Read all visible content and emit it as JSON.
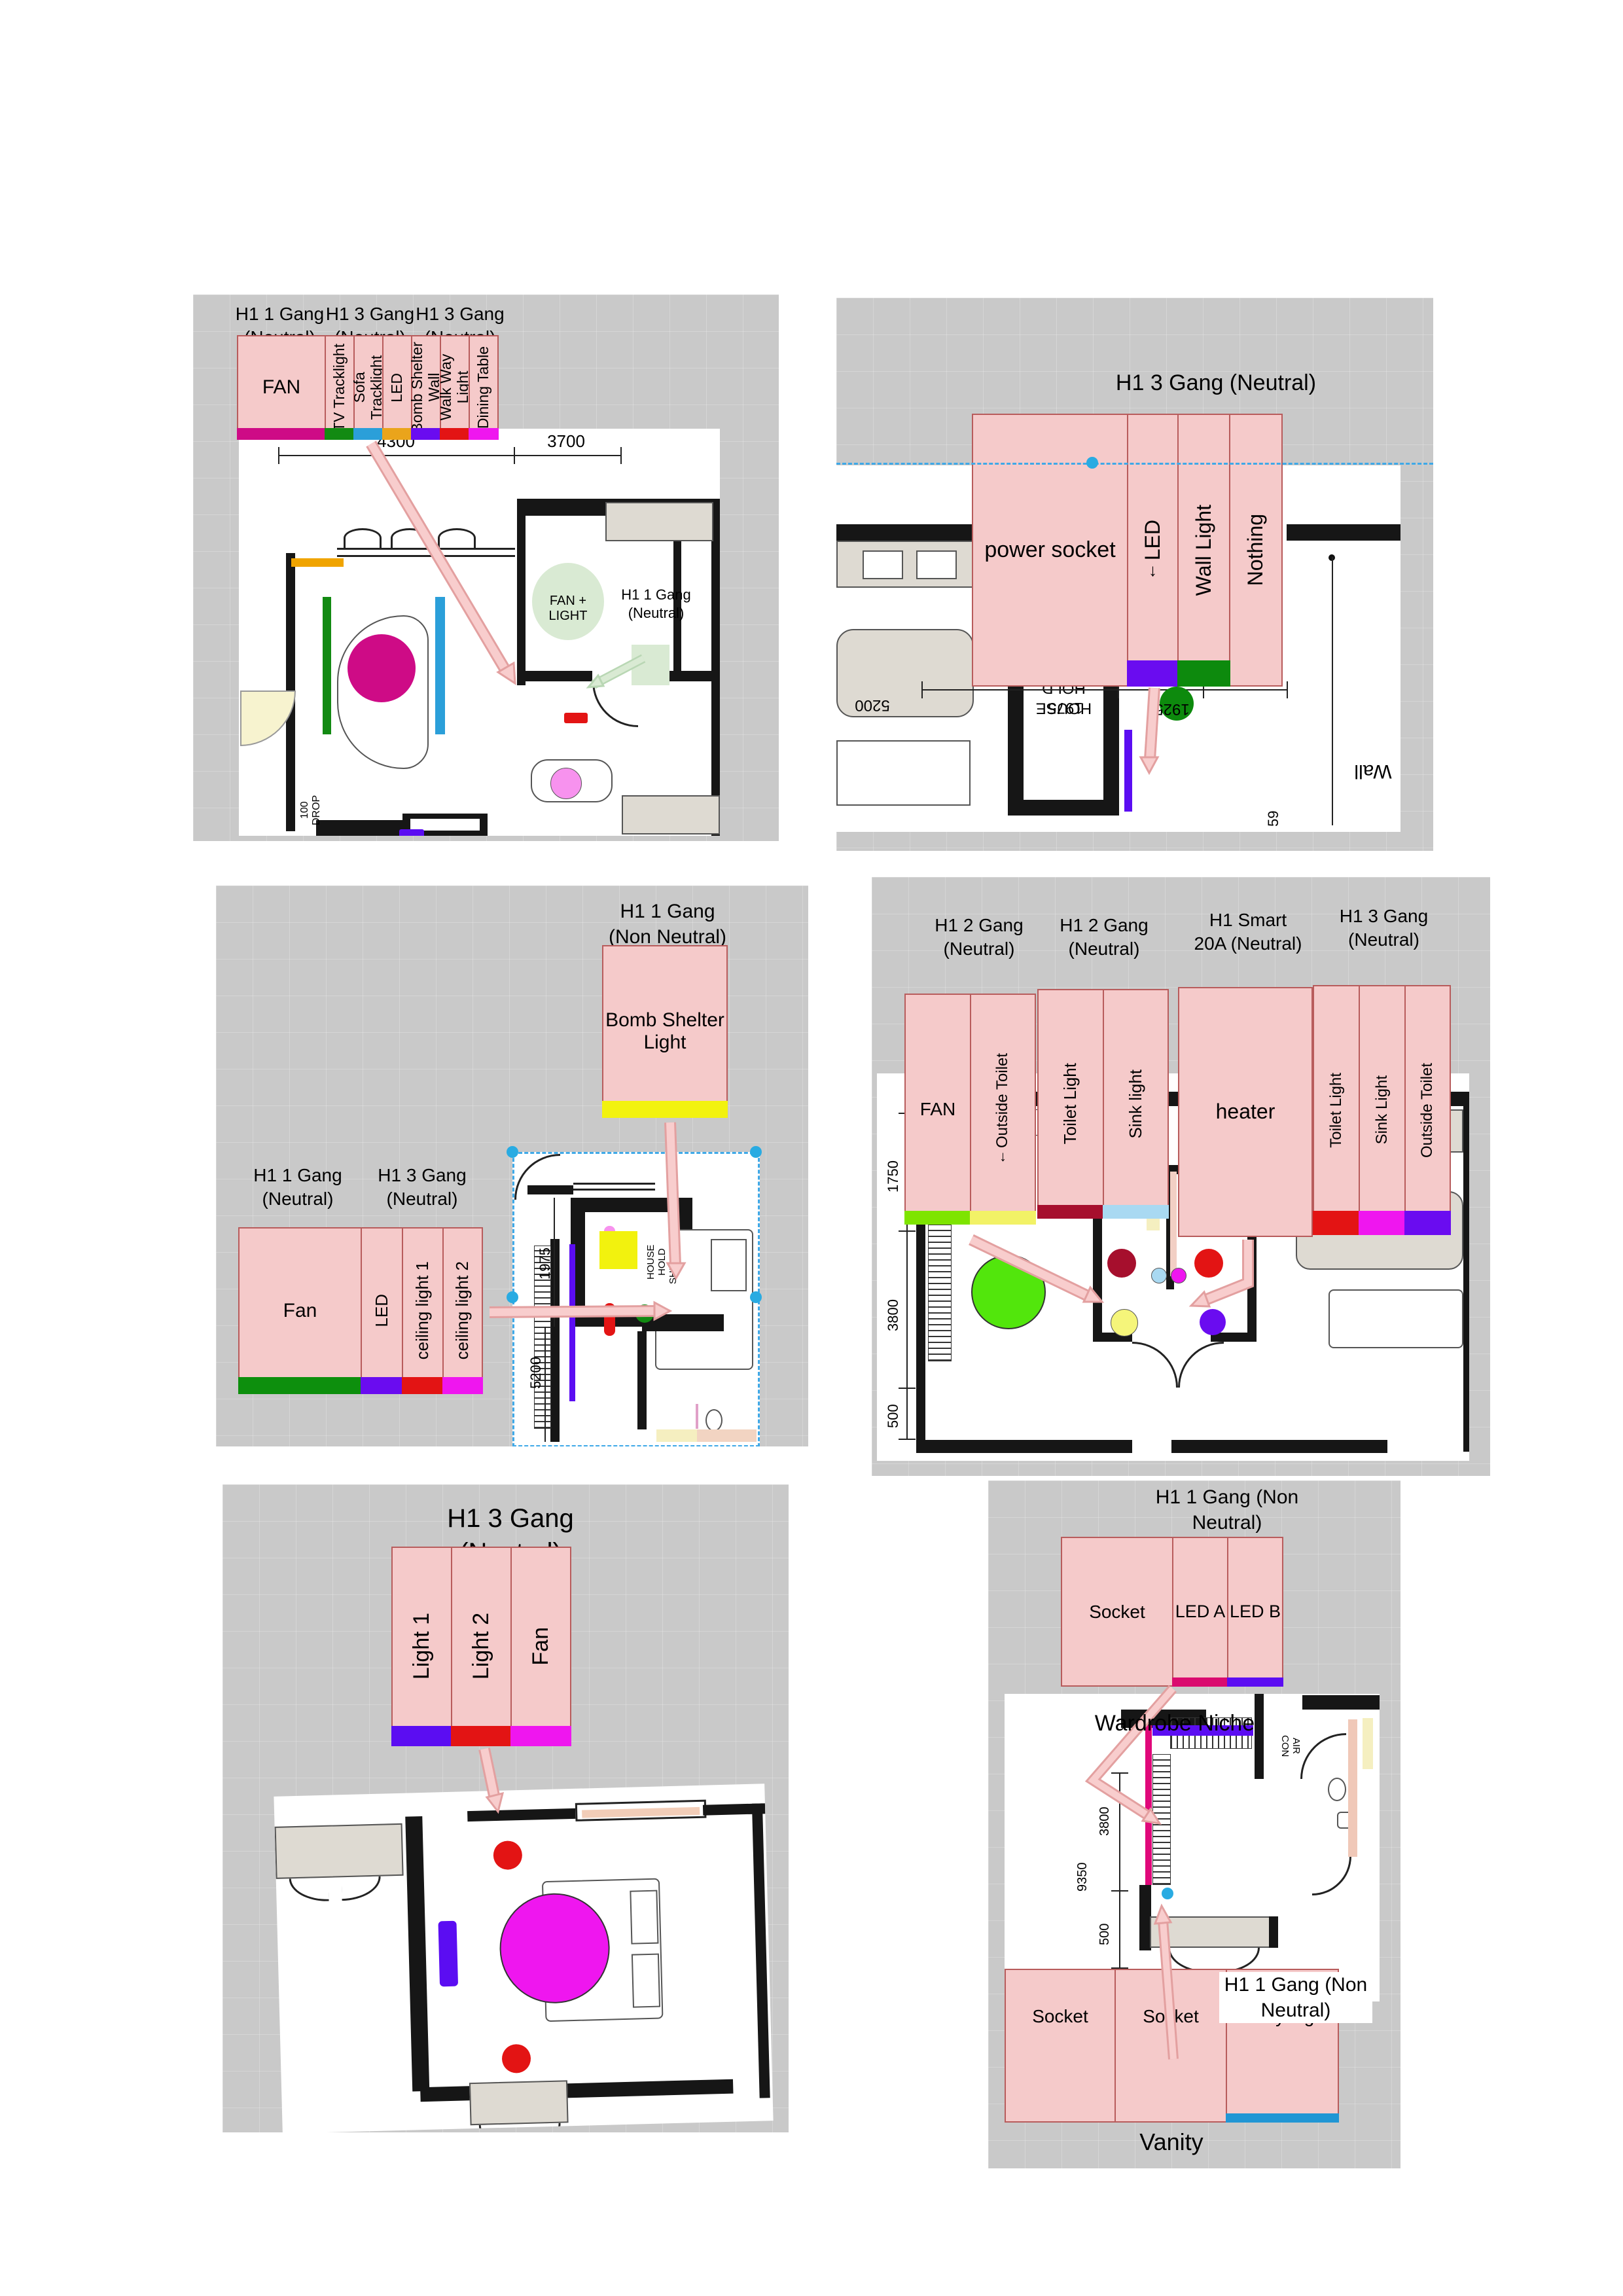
{
  "page": {
    "background": "#ffffff",
    "panel_background": "#c9c9c9"
  },
  "icons": {
    "down_arrow": "↓"
  },
  "colors": {
    "arrow_pink": "#f8cdcd",
    "arrow_pink_edge": "#e3a0a0",
    "dashed_blue": "#3fa9e8",
    "handle_blue": "#29abe2",
    "switch_fill": "#f5caca",
    "switch_border": "#b85c5c"
  },
  "panels": {
    "living": {
      "groups": [
        {
          "title": "H1 1 Gang\n(Neutral)"
        },
        {
          "title": "H1 3 Gang\n(Neutral)"
        },
        {
          "title": "H1 3 Gang\n(Neutral)"
        }
      ],
      "gangs": [
        {
          "label": "FAN",
          "color": "#ce0b86"
        },
        {
          "label": "TV Tracklight",
          "color": "#128a12"
        },
        {
          "label": "Sofa Tracklight",
          "color": "#2b9fd9"
        },
        {
          "label": "LED",
          "color": "#eaa41b"
        },
        {
          "label": "Bomb Shelter Wall",
          "color": "#6a0cf0"
        },
        {
          "label": "Walk Way Light",
          "color": "#e31414"
        },
        {
          "label": "Dining Table",
          "color": "#ef16ef"
        }
      ],
      "dims": {
        "a": "4300",
        "b": "3700"
      },
      "plan": {
        "fan_light": "FAN + LIGHT",
        "gang_note": "H1 1 Gang\n(Neutral)",
        "drop": "100\nDROP"
      },
      "markers": {
        "orange_bar": "#f0a400",
        "green_bar": "#128a12",
        "magenta_circle": "#ce0b86",
        "blue_bar": "#2b9fd9",
        "red_rect": "#e31414",
        "pink_circle": "#f792ee",
        "purple_rect": "#5b0df2",
        "fan_light_fill": "#d9ead3"
      }
    },
    "entry": {
      "title": "H1 3 Gang (Neutral)",
      "gangs": [
        {
          "label": "power socket",
          "color": null
        },
        {
          "label": "LED",
          "color": "#6a0cf0"
        },
        {
          "label": "Wall Light",
          "color": "#0d8a0d"
        },
        {
          "label": "Nothing",
          "color": null
        }
      ],
      "dims": {
        "a": "5200",
        "b": "1975",
        "c": "1925",
        "d": "59"
      },
      "plan": {
        "shelter": "HOUSE\nHOLD\nSHELTER",
        "drop": "100\nDROP",
        "wall": "Wall"
      },
      "markers": {
        "purple_bar": "#5b0df2",
        "green_circle": "#0d8a0d"
      }
    },
    "bedroom2": {
      "bomb_title": "H1 1 Gang\n(Non Neutral)",
      "bomb_label": "Bomb Shelter\nLight",
      "bomb_color": "#f2f20e",
      "groups": [
        {
          "title": "H1 1 Gang\n(Neutral)"
        },
        {
          "title": "H1 3 Gang\n(Neutral)"
        }
      ],
      "gangs": [
        {
          "label": "Fan",
          "color": "#0d8f0d"
        },
        {
          "label": "LED",
          "color": "#6a0cf0"
        },
        {
          "label": "ceiling light 1",
          "color": "#e31414"
        },
        {
          "label": "ceiling light 2",
          "color": "#ef16ef"
        }
      ],
      "dims": {
        "a": "1975",
        "b": "5200"
      },
      "plan": {
        "shelter": "HOUSE\nHOLD\nSHELTER"
      },
      "markers": {
        "yellow_square": "#f2f20e",
        "purple_bar": "#5b0df2",
        "pink_bar": "#f792ee",
        "red_bar": "#e31414",
        "green_circle": "#128a12"
      }
    },
    "bedroom3": {
      "groups": [
        {
          "title": "H1 2 Gang\n(Neutral)"
        },
        {
          "title": "H1 2 Gang\n(Neutral)"
        },
        {
          "title": "H1 Smart\n20A (Neutral)"
        },
        {
          "title": "H1 3 Gang\n(Neutral)"
        }
      ],
      "gangs_a": [
        {
          "label": "FAN",
          "color": "#7ee400"
        },
        {
          "label": "Outside Toilet",
          "color": "#f2f266"
        }
      ],
      "gangs_b": [
        {
          "label": "Toilet Light",
          "color": "#a60f2d"
        },
        {
          "label": "Sink light",
          "color": "#a9d9f2"
        }
      ],
      "gangs_c": [
        {
          "label": "heater",
          "color": null
        }
      ],
      "gangs_d": [
        {
          "label": "Toilet Light",
          "color": "#e31414"
        },
        {
          "label": "Sink Light",
          "color": "#ef16ef"
        },
        {
          "label": "Outside Toilet",
          "color": "#6a0cf0"
        }
      ],
      "dims": {
        "a": "1750",
        "b": "3800",
        "c": "500"
      },
      "plan": {
        "ledge": "AIR\nCON\nLEDGE"
      },
      "markers": {
        "green_circle": "#52e60c",
        "maroon_circle": "#a60f2d",
        "red_circle": "#e31414",
        "lblue_circle": "#a9d9f2",
        "magenta_circle": "#ef16ef",
        "yellow_circle": "#f5f57a",
        "purple_circle": "#6a0cf0"
      }
    },
    "master": {
      "title": "H1 3 Gang\n(Neutral)",
      "gangs": [
        {
          "label": "Light 1",
          "color": "#5b0df2"
        },
        {
          "label": "Light 2",
          "color": "#e31414"
        },
        {
          "label": "Fan",
          "color": "#ef16ef"
        }
      ],
      "markers": {
        "red_circle": "#e31414",
        "magenta_circle": "#ef16ef",
        "purple_bar": "#5b0df2"
      }
    },
    "vanity": {
      "top_title": "H1 1 Gang (Non\nNeutral)",
      "top_gangs": [
        {
          "label": "Socket",
          "color": null
        },
        {
          "label": "LED A",
          "color": "#da0b6f"
        },
        {
          "label": "LED B",
          "color": "#5b0df2"
        }
      ],
      "wardrobe": "Wardrobe Niche",
      "dims": {
        "a": "3800",
        "b": "9350",
        "c": "500"
      },
      "plan": {
        "ledge": "AIR\nCON"
      },
      "bottom_title": "H1 1 Gang (Non\nNeutral)",
      "bottom_gangs": [
        {
          "label": "Socket",
          "color": null
        },
        {
          "label": "Socket",
          "color": null
        },
        {
          "label": "Vanity Light",
          "color": "#2196d4"
        }
      ],
      "caption": "Vanity",
      "markers": {
        "magenta_bar": "#e0087a",
        "purple_bar": "#5b0df2",
        "blue_dot": "#29abe2"
      }
    }
  }
}
